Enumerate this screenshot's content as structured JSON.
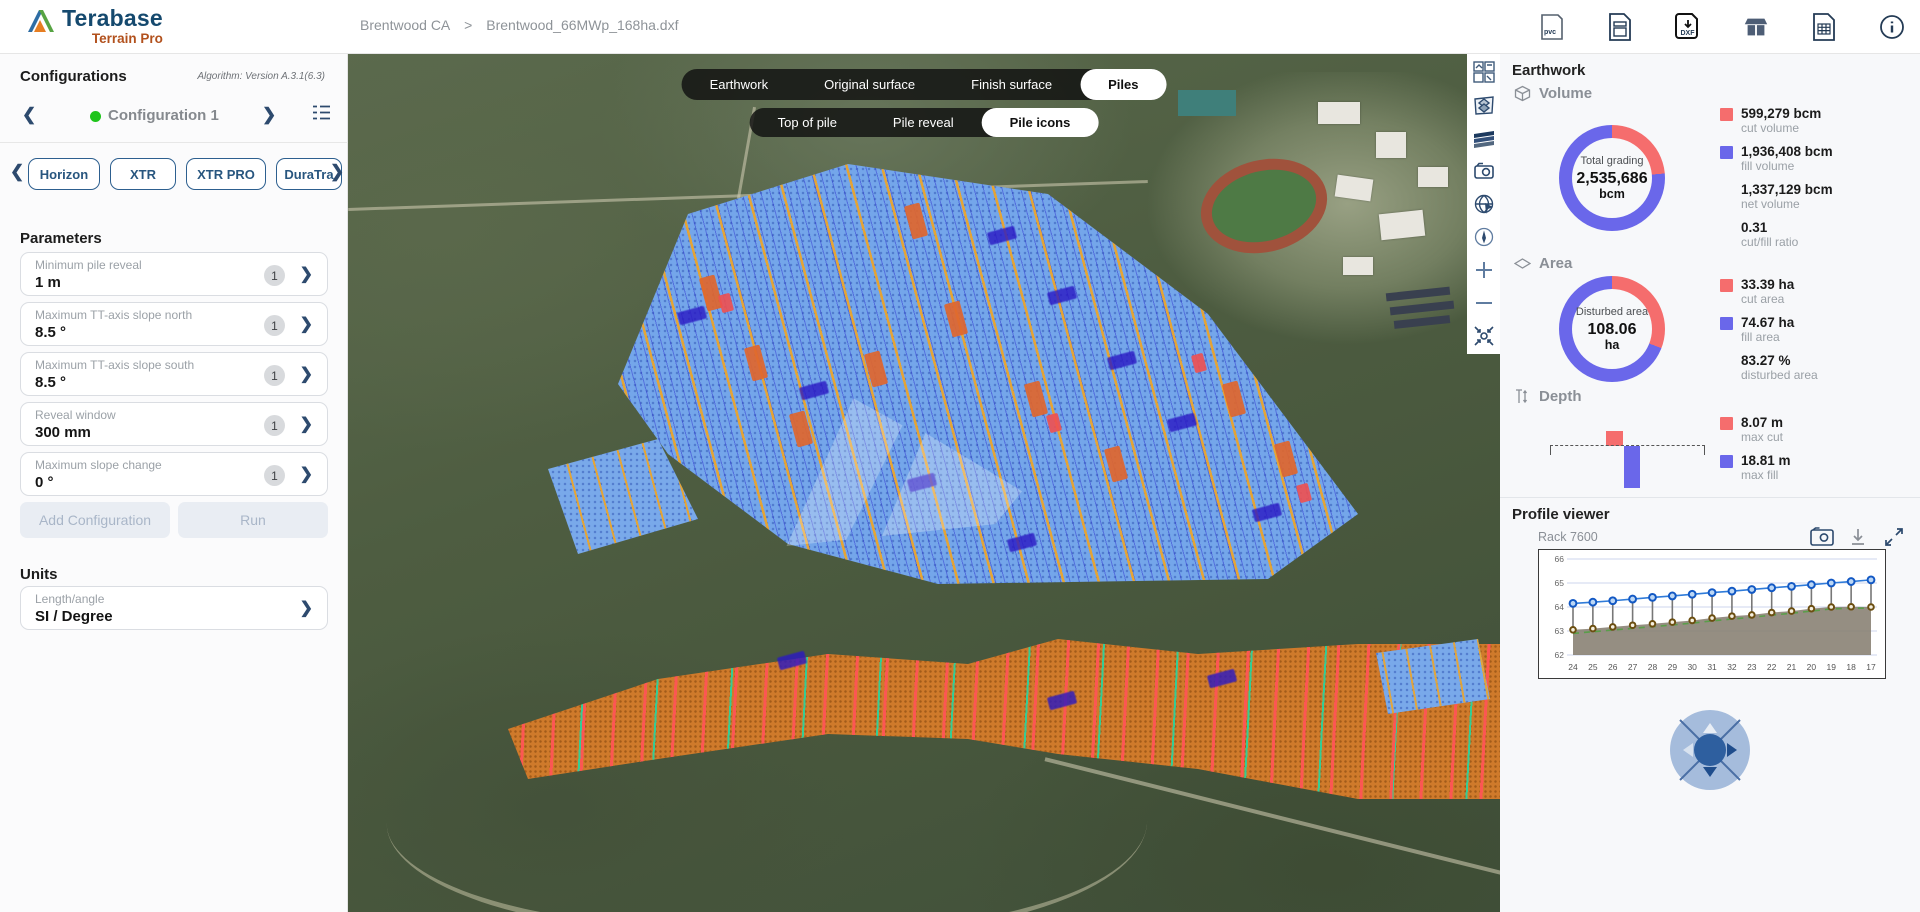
{
  "app": {
    "brand": "Terabase",
    "product": "Terrain Pro"
  },
  "breadcrumb": {
    "project": "Brentwood CA",
    "separator": ">",
    "file": "Brentwood_66MWp_168ha.dxf"
  },
  "glyphs": {
    "chevron_left": "❮",
    "chevron_right": "❯",
    "angle_right": "›",
    "info": "i"
  },
  "topbar": {
    "icons": [
      {
        "name": "pvc-file-icon",
        "text": "pvc"
      },
      {
        "name": "report-file-icon",
        "text": ""
      },
      {
        "name": "dxf-download-icon",
        "text": "DXF"
      },
      {
        "name": "tracker-library-icon",
        "text": ""
      },
      {
        "name": "table-export-icon",
        "text": ""
      },
      {
        "name": "info-icon",
        "text": "i"
      }
    ]
  },
  "sidebar": {
    "title": "Configurations",
    "algorithm": "Algorithm: Version A.3.1(6.3)",
    "config_name": "Configuration 1",
    "tracker_tabs": [
      "Horizon",
      "XTR",
      "XTR PRO",
      "DuraTra"
    ],
    "parameters_title": "Parameters",
    "parameters": [
      {
        "label": "Minimum pile reveal",
        "value": "1 m",
        "badge": "1"
      },
      {
        "label": "Maximum TT-axis slope north",
        "value": "8.5 °",
        "badge": "1"
      },
      {
        "label": "Maximum TT-axis slope south",
        "value": "8.5 °",
        "badge": "1"
      },
      {
        "label": "Reveal window",
        "value": "300 mm",
        "badge": "1"
      },
      {
        "label": "Maximum slope change",
        "value": "0 °",
        "badge": "1"
      }
    ],
    "buttons": {
      "add": "Add Configuration",
      "run": "Run"
    },
    "units_title": "Units",
    "units": {
      "label": "Length/angle",
      "value": "SI / Degree"
    }
  },
  "map": {
    "view_tabs": [
      "Earthwork",
      "Original surface",
      "Finish surface",
      "Piles"
    ],
    "active_view": "Piles",
    "pile_tabs": [
      "Top of pile",
      "Pile reveal",
      "Pile icons"
    ],
    "active_pile_tab": "Pile icons",
    "tools": [
      "basemap",
      "layers",
      "surfaces",
      "screenshot",
      "globe",
      "compass",
      "zoom-in",
      "zoom-out",
      "fit-view"
    ]
  },
  "panel": {
    "title": "Earthwork",
    "volume": {
      "heading": "Volume",
      "center_label": "Total grading",
      "center_value": "2,535,686",
      "center_unit": "bcm",
      "legend": [
        {
          "value": "599,279 bcm",
          "label": "cut volume"
        },
        {
          "value": "1,936,408 bcm",
          "label": "fill volume"
        },
        {
          "value": "1,337,129 bcm",
          "label": "net volume"
        },
        {
          "value": "0.31",
          "label": "cut/fill ratio"
        }
      ]
    },
    "area": {
      "heading": "Area",
      "center_label": "Disturbed area",
      "center_value": "108.06",
      "center_unit": "ha",
      "legend": [
        {
          "value": "33.39 ha",
          "label": "cut area"
        },
        {
          "value": "74.67 ha",
          "label": "fill area"
        },
        {
          "value": "83.27 %",
          "label": "disturbed area"
        }
      ]
    },
    "depth": {
      "heading": "Depth",
      "legend": [
        {
          "value": "8.07 m",
          "label": "max cut"
        },
        {
          "value": "18.81 m",
          "label": "max fill"
        }
      ]
    },
    "profile": {
      "title": "Profile viewer",
      "rack": "Rack 7600"
    }
  },
  "colors": {
    "cut": "#f56d6d",
    "fill": "#6a67ea",
    "top_of_pile_line": "#2f7bd9",
    "ground_marker": "#6b4e10",
    "ground_area": "#8a8274",
    "finish_dashed": "#5a9e4a",
    "accent_navy": "#2d4a6e"
  },
  "chart_data": [
    {
      "type": "pie",
      "subtype": "donut",
      "title": "Volume",
      "center_label": "Total grading",
      "center_value": 2535686,
      "unit": "bcm",
      "slices": [
        {
          "label": "cut volume",
          "value": 599279,
          "color": "#f56d6d"
        },
        {
          "label": "fill volume",
          "value": 1936408,
          "color": "#6a67ea"
        }
      ],
      "extra": [
        {
          "label": "net volume",
          "value": 1337129
        },
        {
          "label": "cut/fill ratio",
          "value": 0.31
        }
      ]
    },
    {
      "type": "pie",
      "subtype": "donut",
      "title": "Area",
      "center_label": "Disturbed area",
      "center_value": 108.06,
      "unit": "ha",
      "slices": [
        {
          "label": "cut area",
          "value": 33.39,
          "color": "#f56d6d"
        },
        {
          "label": "fill area",
          "value": 74.67,
          "color": "#6a67ea"
        }
      ],
      "extra": [
        {
          "label": "disturbed area",
          "value": 83.27,
          "unit": "%"
        }
      ]
    },
    {
      "type": "bar",
      "title": "Depth",
      "categories": [
        "max cut",
        "max fill"
      ],
      "values": [
        8.07,
        18.81
      ],
      "unit": "m",
      "colors": [
        "#f56d6d",
        "#6a67ea"
      ]
    },
    {
      "type": "line",
      "title": "Rack 7600",
      "ylim": [
        62,
        66
      ],
      "yticks": [
        62,
        63,
        64,
        65,
        66
      ],
      "categories": [
        "24",
        "25",
        "26",
        "27",
        "28",
        "29",
        "30",
        "31",
        "32",
        "23",
        "22",
        "21",
        "20",
        "19",
        "18",
        "17"
      ],
      "series": [
        {
          "name": "top of pile",
          "values": [
            64.15,
            64.2,
            64.26,
            64.33,
            64.4,
            64.46,
            64.53,
            64.6,
            64.66,
            64.73,
            64.8,
            64.86,
            64.93,
            65.0,
            65.06,
            65.13
          ]
        },
        {
          "name": "original ground",
          "values": [
            63.05,
            63.1,
            63.17,
            63.24,
            63.3,
            63.37,
            63.44,
            63.54,
            63.62,
            63.67,
            63.77,
            63.83,
            63.93,
            64.0,
            64.01,
            64.0
          ]
        },
        {
          "name": "finish surface",
          "values": [
            62.9,
            62.97,
            63.04,
            63.11,
            63.18,
            63.25,
            63.33,
            63.42,
            63.5,
            63.57,
            63.66,
            63.74,
            63.83,
            63.92,
            63.95,
            63.95
          ]
        }
      ],
      "legend_position": "none",
      "grid": true
    }
  ]
}
